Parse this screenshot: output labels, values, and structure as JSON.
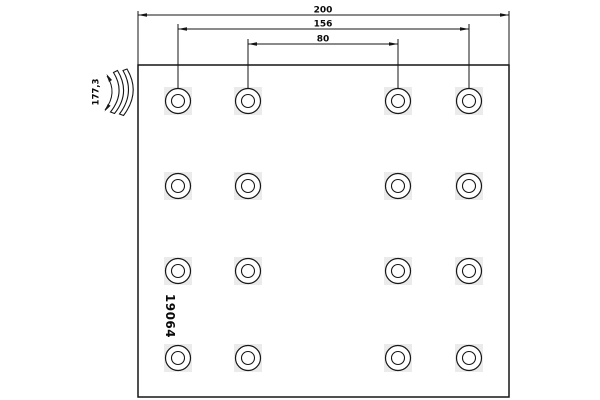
{
  "drawing": {
    "part_number": "19064",
    "dimension_labels": {
      "total_width": "200",
      "outer_rivet_spacing": "156",
      "inner_rivet_spacing": "80",
      "arc_length": "177,3"
    },
    "rivet_grid": {
      "rows": 4,
      "columns": 4,
      "total_holes": 16
    },
    "colors": {
      "line": "#151515",
      "background": "#ffffff",
      "hole_halo": "#ebebeb"
    }
  }
}
